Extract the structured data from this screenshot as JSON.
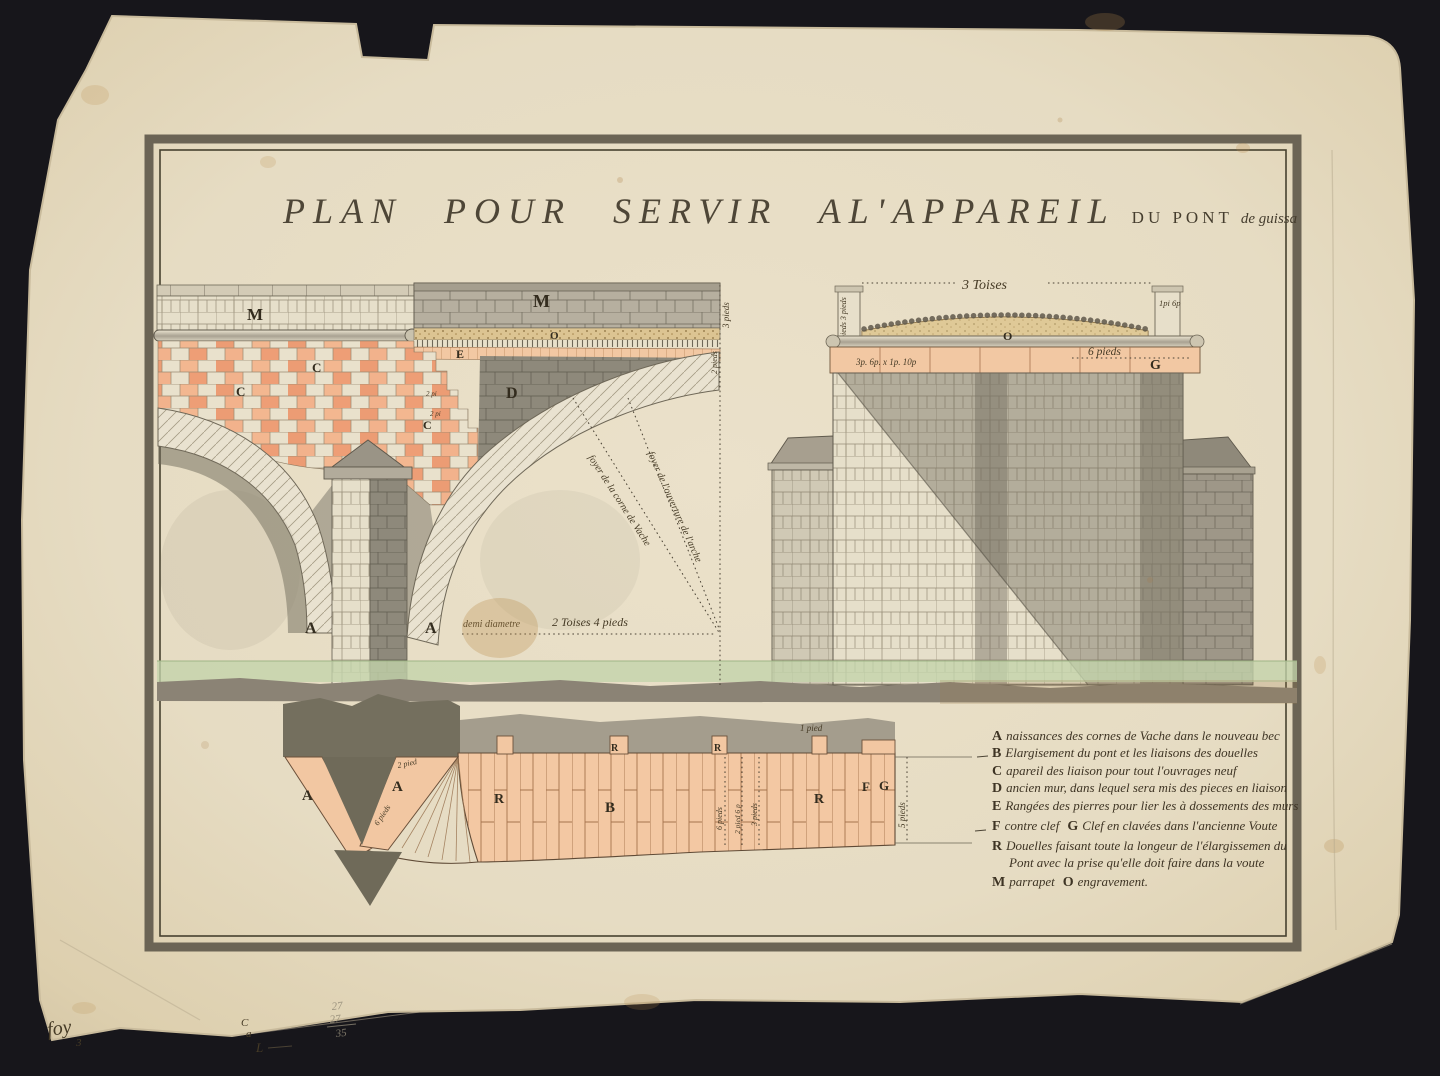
{
  "title": {
    "main": "PLAN POUR SERVIR AL'APPAREIL",
    "sub": "DU PONT",
    "script": "de guissa"
  },
  "labels": {
    "parapet_left": "M",
    "parapet_right": "M",
    "engravement_band": "O",
    "rang_band": "E",
    "brick1": "C",
    "brick2": "C",
    "brick3": "C",
    "old_wall": "D",
    "arch_left": "A",
    "arch_right": "A",
    "deck_pave": "O",
    "deck_key": "G",
    "sec_bec_left": "A",
    "sec_bec_right": "A",
    "sec_r1": "R",
    "sec_r2": "R",
    "sec_r3": "R",
    "sec_r4": "R",
    "sec_b": "B",
    "sec_f": "F",
    "sec_g": "G"
  },
  "annotations": {
    "three_toises": "3 Toises",
    "post_left": "2 pieds 3 pieds",
    "post_right": "1pi 6p",
    "deck_dims": "3p. 6p. x 1p. 10p",
    "deck_six_pieds": "6 pieds",
    "demi_diametre": "demi diametre",
    "two_toises_four": "2 Toises 4 pieds",
    "foyer_corne": "foyer de la corne de Vache",
    "foyer_ouverture": "foyer de l'ouverture de l'arche",
    "edge_three_pieds": "3 pieds",
    "edge_two_pieds": "2 pieds",
    "step_two_pi_a": "2 pi",
    "step_two_pi_b": "2 pi",
    "sec_two_pied": "2 pied",
    "sec_six_pieds": "6 pieds",
    "sec_one_pied": "1 pied",
    "col_six_pieds": "6 pieds",
    "col_two_pied_six": "2 pied 6 p",
    "col_three_pieds": "3 pieds",
    "sec_five_pieds": "5 pieds"
  },
  "legend": {
    "entries": [
      {
        "k": "A",
        "t": "naissances des cornes de Vache dans le nouveau bec"
      },
      {
        "k": "B",
        "t": "Elargisement du pont et les liaisons des douelles"
      },
      {
        "k": "C",
        "t": "apareil des liaison pour tout l'ouvrages neuf"
      },
      {
        "k": "D",
        "t": "ancien mur, dans lequel sera mis des pieces en liaison"
      },
      {
        "k": "E",
        "t": "Rangées des pierres pour lier les à dossements des murs"
      },
      {
        "k": "F",
        "t": "contre clef",
        "k2": "G",
        "t2": "Clef en clavées dans l'ancienne Voute"
      },
      {
        "k": "R",
        "t": "Douelles faisant toute la longeur de l'élargissemen du Pont avec la prise qu'elle doit faire dans la voute"
      },
      {
        "k": "M",
        "t": "parrapet",
        "k2": "O",
        "t2": "engravement."
      }
    ]
  },
  "marginalia": {
    "sig": "foy",
    "sig_num": "3",
    "note_c": "C",
    "note_a": "a",
    "note_l": "L",
    "pencil_1": "27",
    "pencil_2": "27",
    "pencil_sum": "35"
  },
  "colors": {
    "background": "#17161b",
    "paper": "#e6dcc3",
    "frame": "#6b6455",
    "ink": "#3a3223",
    "brick_pink": "#ec9c74",
    "salmon": "#f2c7a2",
    "water": "#c3d3aa",
    "grey_masonry": "#b2ab9b",
    "shadow": "#6d685b",
    "tan": "#d9c08e"
  }
}
